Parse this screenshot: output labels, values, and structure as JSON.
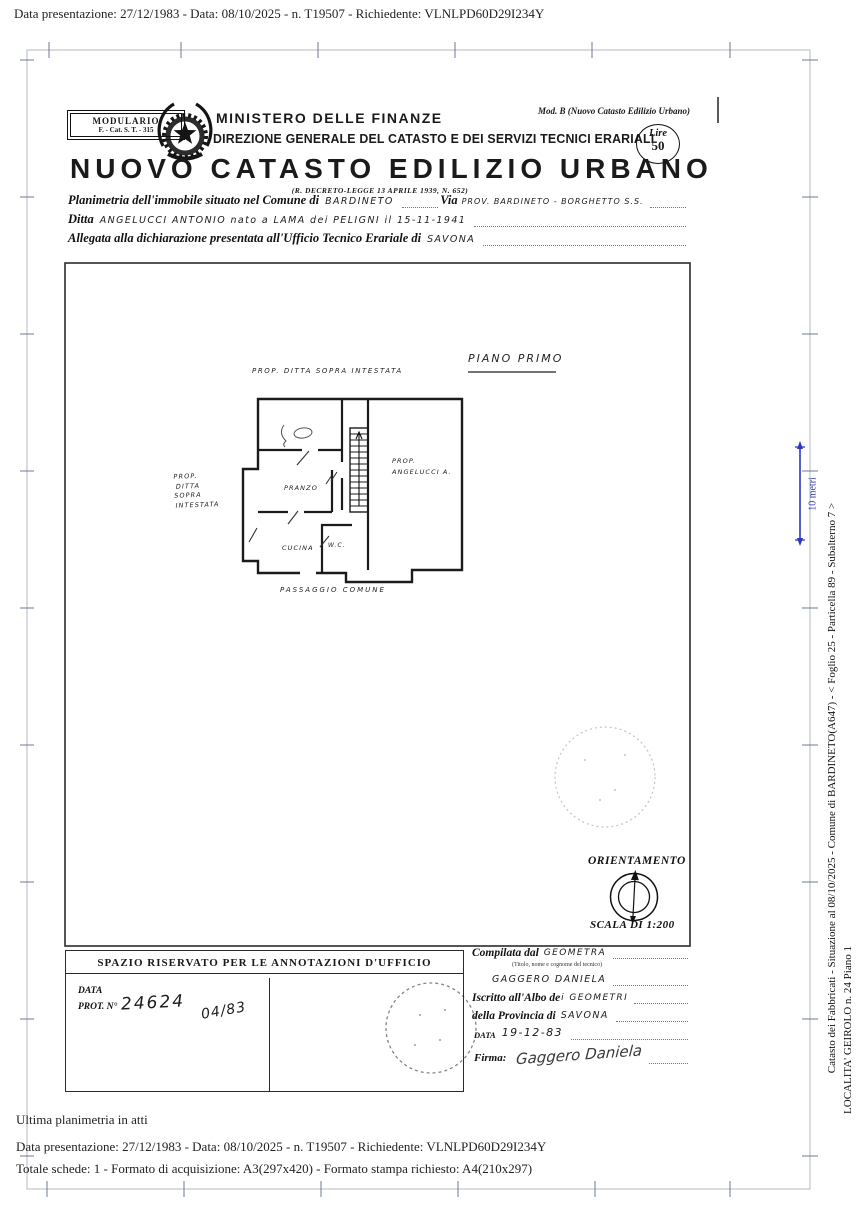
{
  "colors": {
    "ink": "#1a1a1a",
    "scan_blue": "#2a35c0"
  },
  "scan_header": {
    "line": "Data presentazione: 27/12/1983 - Data: 08/10/2025 - n. T19507 - Richiedente: VLNLPD60D29I234Y"
  },
  "masthead": {
    "modulario_line1": "MODULARIO",
    "modulario_line2": "F. - Cat. S. T. - 315",
    "mod_b": "Mod. B (Nuovo Catasto Edilizio Urbano)",
    "ministry": "MINISTERO DELLE FINANZE",
    "direction": "DIREZIONE GENERALE DEL CATASTO E DEI SERVIZI TECNICI ERARIALI",
    "stamp_line1": "Lire",
    "stamp_line2": "50",
    "title": "NUOVO CATASTO EDILIZIO URBANO",
    "decree": "(R. DECRETO-LEGGE 13 APRILE 1939, N. 652)"
  },
  "fields": {
    "line1_label": "Planimetria dell'immobile situato nel Comune di",
    "line1_value": "BARDINETO",
    "via_label": "Via",
    "via_value": "PROV. BARDINETO - BORGHETTO S.S.",
    "ditta_label": "Ditta",
    "ditta_value": "ANGELUCCI ANTONIO nato a LAMA dei PELIGNI il 15-11-1941",
    "allegata_label": "Allegata alla dichiarazione presentata all'Ufficio Tecnico Erariale di",
    "allegata_value": "SAVONA"
  },
  "plan": {
    "floor_title": "PIANO PRIMO",
    "top_label": "PROP. DITTA SOPRA INTESTATA",
    "left_lines": [
      "PROP.",
      "DITTA",
      "SOPRA",
      "INTESTATA"
    ],
    "right_line1": "PROP.",
    "right_line2": "ANGELUCCI A.",
    "room_pranzo": "PRANZO",
    "room_cucina": "CUCINA",
    "room_wc": "W.C.",
    "bottom_label": "PASSAGGIO COMUNE",
    "orientation_label": "ORIENTAMENTO",
    "scale_label": "SCALA DI 1:200"
  },
  "annotations_box": {
    "header": "SPAZIO RISERVATO PER LE ANNOTAZIONI D'UFFICIO",
    "data_label": "DATA",
    "prot_label": "PROT. N°",
    "prot_value": "24624",
    "date_value": "04/83"
  },
  "compiler_box": {
    "row1_label": "Compilata dal",
    "row1_value": "GEOMETRA",
    "row1_note": "(Titolo, nome e cognome del tecnico)",
    "row2_value": "GAGGERO DANIELA",
    "row3_label": "Iscritto all'Albo de",
    "row3_value": "i GEOMETRI",
    "row4_label": "della Provincia di",
    "row4_value": "SAVONA",
    "row5_label": "DATA",
    "row5_value": "19-12-83",
    "firma_label": "Firma:",
    "firma_value": "Gaggero Daniela"
  },
  "sidebar_right": {
    "scale_bar_label": "10 metri",
    "line1": "Catasto dei Fabbricati - Situazione al 08/10/2025 - Comune di BARDINETO(A647) - < Foglio 25 - Particella  89 - Subalterno 7 >",
    "line2": "LOCALITA' GEIROLO n. 24 Piano 1"
  },
  "footer": {
    "line1": "Ultima planimetria in atti",
    "line2": "Data presentazione: 27/12/1983 - Data: 08/10/2025 - n. T19507 - Richiedente: VLNLPD60D29I234Y",
    "line3": "Totale schede: 1 - Formato di acquisizione: A3(297x420)  - Formato stampa richiesto: A4(210x297)"
  }
}
